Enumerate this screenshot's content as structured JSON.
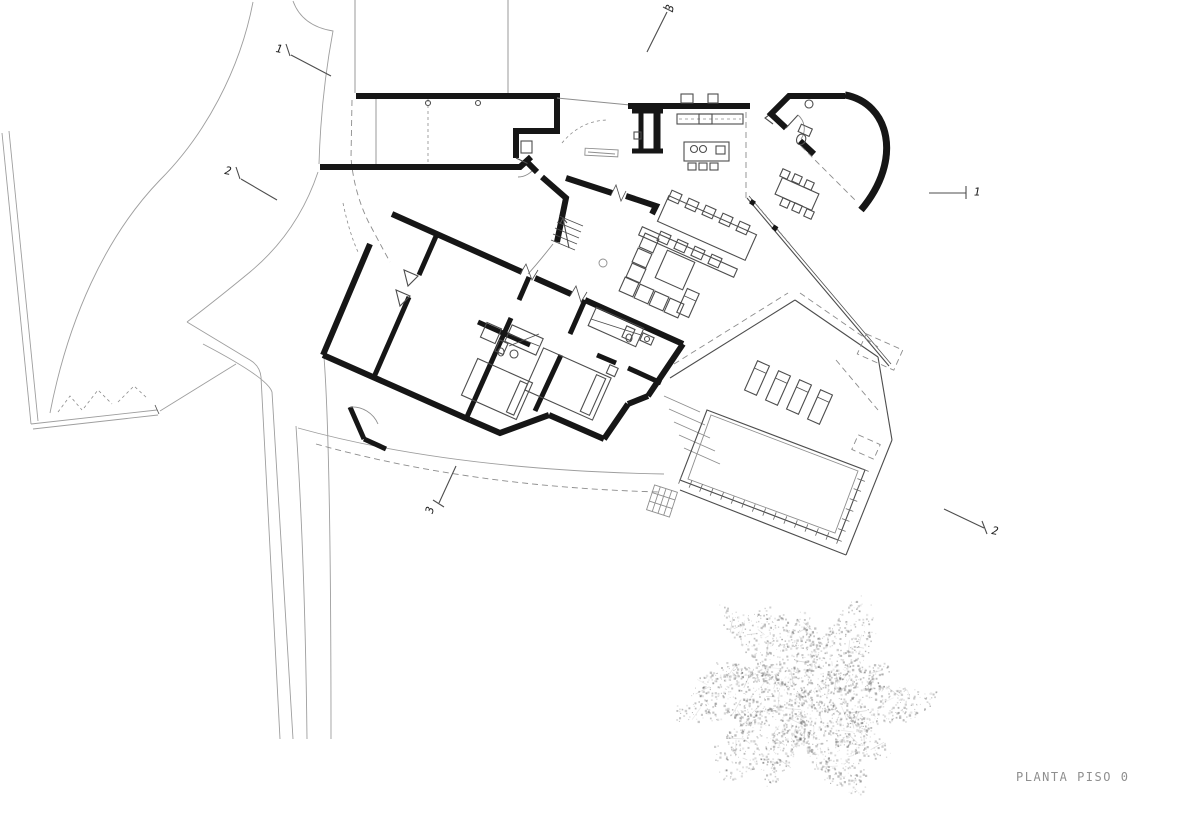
{
  "drawing": {
    "caption": "PLANTA PISO 0",
    "section_markers": [
      {
        "label": "3",
        "position": "top"
      },
      {
        "label": "1",
        "position": "top-left"
      },
      {
        "label": "2",
        "position": "left"
      },
      {
        "label": "1",
        "position": "right"
      },
      {
        "label": "2",
        "position": "bottom-right"
      },
      {
        "label": "3",
        "position": "bottom-left"
      }
    ],
    "colors": {
      "background": "#ffffff",
      "wall": "#161616",
      "line_medium": "#4d4d4d",
      "line_light": "#8e8e8e",
      "site": "#9e9e9e",
      "dashed": "#8c8c8c",
      "tree": "#bfbfbf",
      "caption_text": "#8f8f8f",
      "marker_text": "#1c1c1c"
    }
  }
}
